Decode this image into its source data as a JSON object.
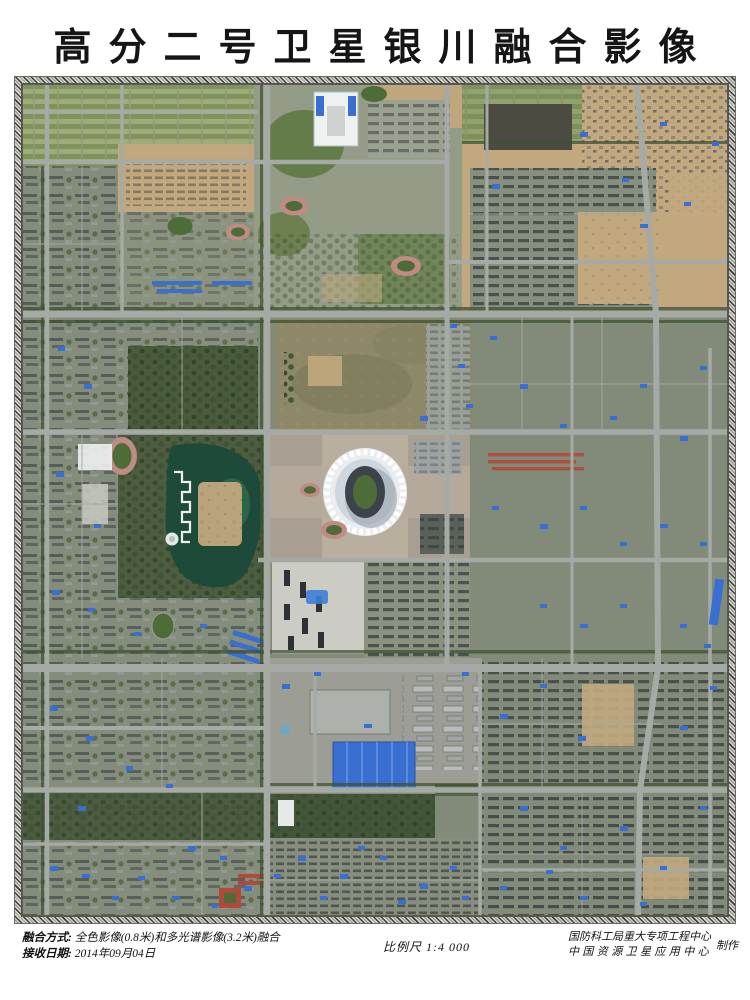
{
  "title": "高分二号卫星银川融合影像",
  "footer": {
    "fusion_label": "融合方式:",
    "fusion_value": "全色影像(0.8米)和多光谱影像(3.2米)融合",
    "date_label": "接收日期:",
    "date_value": "2014年09月04日",
    "scale": "比例尺 1:4 000",
    "producer_line1": "国防科工局重大专项工程中心",
    "producer_line2": "中国资源卫星应用中心",
    "producer_suffix": "制作"
  },
  "map": {
    "palette": {
      "urban_base": "#828a7a",
      "road_gray": "#a6aaa4",
      "vegetation_dark": "#3e5231",
      "lawn_green": "#64794a",
      "field_green": "#4d6c38",
      "sand_tan": "#c2a87e",
      "bare_olive": "#8d8867",
      "water_dark": "#1d4a39",
      "blue_roof": "#3a6fd2",
      "white_roof": "#eef1f2",
      "track_pink": "#c08b82",
      "dark_roof": "#2e3336",
      "red_roof": "#b04a3a",
      "plaza_tan": "#b2a795"
    }
  }
}
